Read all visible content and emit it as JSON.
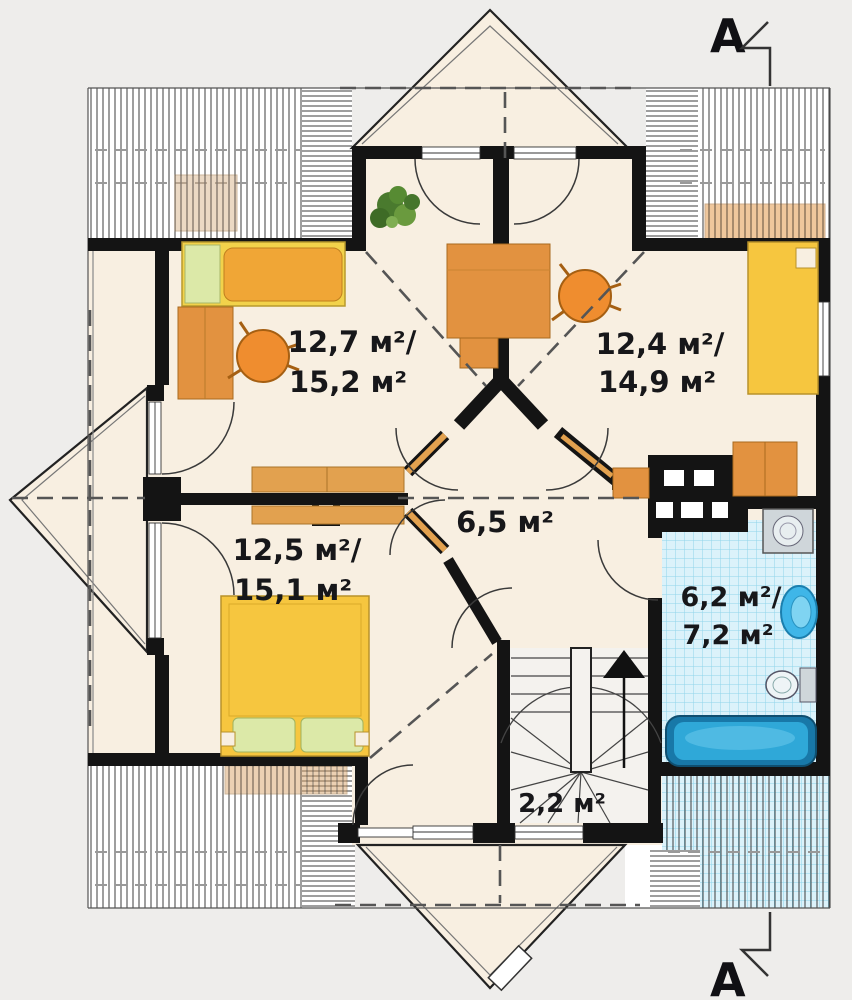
{
  "plan": {
    "type": "attic-floor-plan",
    "section_markers": {
      "top": "A",
      "bottom": "A"
    },
    "rooms": {
      "bedroom_nw": {
        "area_line1": "12,7 м²/",
        "area_line2": "15,2 м²"
      },
      "bedroom_ne": {
        "area_line1": "12,4 м²/",
        "area_line2": "14,9 м²"
      },
      "bedroom_sw": {
        "area_line1": "12,5 м²/",
        "area_line2": "15,1 м²"
      },
      "hall": {
        "area_line1": "6,5 м²"
      },
      "bathroom": {
        "area_line1": "6,2 м²/",
        "area_line2": "7,2 м²"
      },
      "staircase": {
        "area_line1": "2,2 м²"
      }
    },
    "colors": {
      "background": "#eeedeb",
      "floor_cream": "#f8efe1",
      "wall_black": "#141414",
      "bed_yellow": "#f6c63f",
      "blanket_orange": "#f0a636",
      "furniture_orange": "#e29240",
      "chair_orange": "#ef8d2f",
      "pillow_green": "#dce9a8",
      "tile_blue": "#dbf2fa",
      "fixture_blue": "#3fb6e8",
      "bathtub_blue": "#1878a8"
    }
  }
}
